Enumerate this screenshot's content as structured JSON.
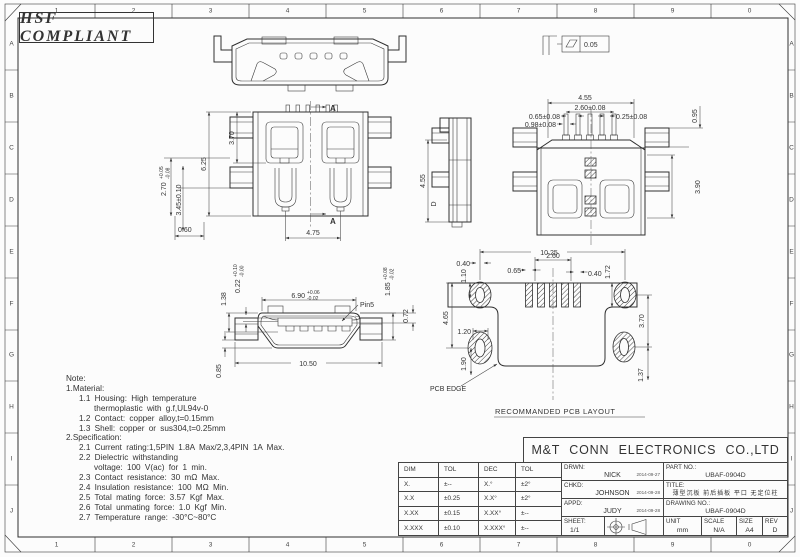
{
  "sheet": {
    "hsf_label": "HSF COMPLIANT",
    "zones_top": [
      "1",
      "2",
      "3",
      "4",
      "5",
      "6",
      "7",
      "8",
      "9",
      "0"
    ],
    "zones_bottom": [
      "1",
      "2",
      "3",
      "4",
      "5",
      "6",
      "7",
      "8",
      "9",
      "0"
    ],
    "zones_left": [
      "A",
      "B",
      "C",
      "D",
      "E",
      "F",
      "G",
      "H",
      "I",
      "J"
    ],
    "zones_right": [
      "A",
      "B",
      "C",
      "D",
      "E",
      "F",
      "G",
      "H",
      "I",
      "J"
    ]
  },
  "views": {
    "top_view": {
      "flatness_value": "0.05"
    },
    "plan_view": {
      "section_label": "A",
      "dim_height_overall": "6.25",
      "dim_height_inner": "3.70",
      "dim_tail": "2.70",
      "dim_tail_tol_up": "+0.05",
      "dim_tail_tol_dn": "-0.08",
      "dim_tail2": "3.45±0.10",
      "dim_offset": "0.60",
      "dim_leg_span": "4.75"
    },
    "side_view": {
      "dim_height": "4.55",
      "marker": "D"
    },
    "bottom_view": {
      "dim_pin_row": "4.55",
      "dim_pin_span": "2.60±0.08",
      "dim_pin_pitch": "0.65±0.08",
      "dim_pin_foot": "0.98±0.08",
      "dim_pin_width": "0.25±0.08",
      "dim_leg_edge": "0.95",
      "dim_depth": "3.90"
    },
    "front_view": {
      "dim_opening": "6.90",
      "dim_opening_tol_up": "+0.06",
      "dim_opening_tol_dn": "-0.02",
      "pin_label": "Pin5",
      "dim_tongue": "0.22",
      "dim_tongue_tol_up": "+0.10",
      "dim_tongue_tol_dn": "-0.00",
      "dim_lip": "1.38",
      "dim_inner_h": "1.85",
      "dim_inner_h_tol_up": "+0.08",
      "dim_inner_h_tol_dn": "-0.02",
      "dim_step": "0.72",
      "dim_width_overall": "10.50",
      "dim_foot": "0.85"
    },
    "pcb_layout": {
      "title": "RECOMMANDED PCB LAYOUT",
      "edge_label": "PCB EDGE",
      "dim_overall": "10.25",
      "dim_pitch": "2.60",
      "dim_pad_w_left": "0.40",
      "dim_pad_gap": "0.65",
      "dim_pad_w_right": "0.40",
      "dim_top_left_h": "1.10",
      "dim_top_right_h": "1.72",
      "dim_left_h": "4.65",
      "dim_right_h": "3.70",
      "dim_pad_left_w": "1.20",
      "dim_bottom_left": "1.90",
      "dim_bottom_right": "1.37"
    }
  },
  "notes": {
    "lines": [
      "Note:",
      "1.Material:",
      "1.1  Housing:  High  temperature",
      "thermoplastic  with  g.f,UL94v-0",
      "1.2  Contact:  copper  alloy,t=0.15mm",
      "1.3  Shell:  copper  or  sus304,t=0.25mm",
      "2.Specification:",
      "2.1  Current  rating:1,5PIN  1.8A  Max/2,3,4PIN  1A  Max.",
      "2.2  Dielectric  withstanding",
      "voltage:  100  V(ac)  for  1  min.",
      "2.3  Contact  resistance:  30  mΩ  Max.",
      "2.4  Insulation  resistance:  100  MΩ  Min.",
      "2.5  Total  mating  force:  3.57  Kgf  Max.",
      "2.6  Total  unmating  force:  1.0  Kgf  Min.",
      "2.7  Temperature  range:  -30°C~80°C"
    ]
  },
  "title_block": {
    "company": "M&T CONN ELECTRONICS CO.,LTD",
    "drwn_label": "DRWN:",
    "drwn_name": "NICK",
    "drwn_date": "2014-09-27",
    "chkd_label": "CHKD:",
    "chkd_name": "JOHNSON",
    "chkd_date": "2014-09-28",
    "appd_label": "APPD:",
    "appd_name": "JUDY",
    "appd_date": "2014-09-28",
    "sheet_label": "SHEET:",
    "sheet_value": "1/1",
    "part_no_label": "PART NO.:",
    "part_no": "UBAF-0904D",
    "title_label": "TITLE:",
    "title_value": "薄型沉板 前后插板 平口 无定位柱",
    "drawing_no_label": "DRAWING NO.:",
    "drawing_no": "UBAF-0904D",
    "unit_label": "UNIT",
    "unit_value": "mm",
    "scale_label": "SCALE",
    "scale_value": "N/A",
    "size_label": "SIZE",
    "size_value": "A4",
    "rev_label": "REV",
    "rev_value": "D"
  },
  "tol_table": {
    "headers": [
      "DIM",
      "TOL",
      "DEC",
      "TOL"
    ],
    "rows": [
      [
        "X.",
        "±--",
        "X.°",
        "±2°"
      ],
      [
        "X.X",
        "±0.25",
        "X.X°",
        "±2°"
      ],
      [
        "X.XX",
        "±0.15",
        "X.XX°",
        "±--"
      ],
      [
        "X.XXX",
        "±0.10",
        "X.XXX°",
        "±--"
      ]
    ]
  }
}
